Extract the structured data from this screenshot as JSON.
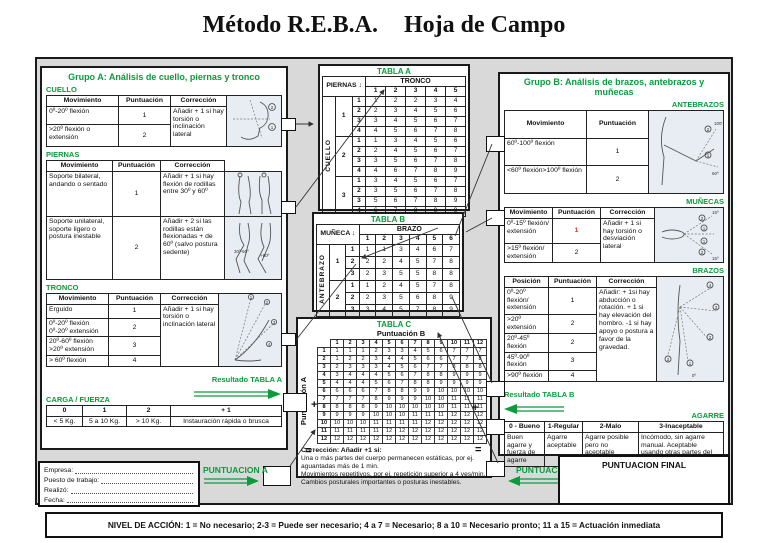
{
  "title": {
    "left": "Método R.E.B.A.",
    "right": "Hoja de Campo"
  },
  "icons": {
    "down_arrow": "↓"
  },
  "operators": {
    "plus": "+",
    "equals": "="
  },
  "group_a": {
    "title": "Grupo A: Análisis de cuello, piernas y tronco",
    "cuello": {
      "label": "CUELLO",
      "headers": [
        "Movimiento",
        "Puntuación",
        "Corrección"
      ],
      "rows": [
        [
          "0º-20º flexión",
          "1"
        ],
        [
          ">20º flexión o extensión",
          "2"
        ]
      ],
      "correction": "Añadir + 1 si hay torsión o inclinación lateral"
    },
    "piernas": {
      "label": "PIERNAS",
      "headers": [
        "Movimiento",
        "Puntuación",
        "Corrección"
      ],
      "rows": [
        {
          "mov": "Soporte bilateral, andando o sentado",
          "punt": "1",
          "corr": "Añadir + 1 si hay flexión de rodillas entre 30º y 60º"
        },
        {
          "mov": "Soporte unilateral, soporte ligero o postura inestable",
          "punt": "2",
          "corr": "Añadir + 2 si las rodillas están flexionadas + de 60º (salvo postura sedente)"
        }
      ]
    },
    "tronco": {
      "label": "TRONCO",
      "headers": [
        "Movimiento",
        "Puntuación",
        "Corrección"
      ],
      "rows": [
        [
          "Erguido",
          "1"
        ],
        [
          "0º-20º flexión 0º-20º extensión",
          "2"
        ],
        [
          "20º-60º flexión >20º extensión",
          "3"
        ],
        [
          "> 60º  flexión",
          "4"
        ]
      ],
      "correction": "Añadir + 1 si hay torsión o inclinación lateral"
    },
    "resultado_label": "Resultado TABLA A",
    "carga": {
      "label": "CARGA / FUERZA",
      "headers": [
        "0",
        "1",
        "2",
        "+ 1"
      ],
      "values": [
        "< 5 Kg.",
        "5 a 10 Kg.",
        "> 10 Kg.",
        "Instauración rápida o brusca"
      ]
    }
  },
  "tabla_a": {
    "title": "TABLA A",
    "corner_label": "PIERNAS",
    "col_group": "TRONCO",
    "side_label": "CUELLO",
    "col_labels": [
      "1",
      "2",
      "3",
      "4",
      "5"
    ],
    "groups": [
      {
        "label": "1",
        "rows": [
          [
            1,
            2,
            2,
            3,
            4
          ],
          [
            2,
            3,
            4,
            5,
            6
          ],
          [
            3,
            4,
            5,
            6,
            7
          ],
          [
            4,
            5,
            6,
            7,
            8
          ]
        ]
      },
      {
        "label": "2",
        "rows": [
          [
            1,
            3,
            4,
            5,
            6
          ],
          [
            2,
            4,
            5,
            6,
            7
          ],
          [
            3,
            5,
            6,
            7,
            8
          ],
          [
            4,
            6,
            7,
            8,
            9
          ]
        ]
      },
      {
        "label": "3",
        "rows": [
          [
            3,
            4,
            5,
            6,
            7
          ],
          [
            3,
            5,
            6,
            7,
            8
          ],
          [
            5,
            6,
            7,
            8,
            9
          ],
          [
            6,
            7,
            8,
            9,
            9
          ]
        ]
      }
    ]
  },
  "tabla_b": {
    "title": "TABLA B",
    "corner_label": "MUÑECA",
    "col_group": "BRAZO",
    "side_label": "ANTEBRAZO",
    "col_labels": [
      "1",
      "2",
      "3",
      "4",
      "5",
      "6"
    ],
    "groups": [
      {
        "label": "1",
        "rows": [
          [
            1,
            1,
            3,
            4,
            6,
            7
          ],
          [
            2,
            2,
            4,
            5,
            7,
            8
          ],
          [
            2,
            3,
            5,
            5,
            8,
            8
          ]
        ]
      },
      {
        "label": "2",
        "rows": [
          [
            1,
            2,
            4,
            5,
            7,
            8
          ],
          [
            2,
            3,
            5,
            6,
            8,
            9
          ],
          [
            3,
            4,
            5,
            7,
            8,
            9
          ]
        ]
      }
    ]
  },
  "tabla_c": {
    "title": "TABLA C",
    "col_label": "Puntuación B",
    "row_label": "Puntuación A",
    "col_labels": [
      "1",
      "2",
      "3",
      "4",
      "5",
      "6",
      "7",
      "8",
      "9",
      "10",
      "11",
      "12"
    ],
    "rows": [
      [
        1,
        1,
        1,
        2,
        3,
        3,
        4,
        5,
        6,
        7,
        7,
        7
      ],
      [
        1,
        2,
        2,
        3,
        4,
        4,
        5,
        6,
        6,
        7,
        7,
        8
      ],
      [
        2,
        3,
        3,
        3,
        4,
        5,
        6,
        7,
        7,
        8,
        8,
        8
      ],
      [
        3,
        4,
        4,
        4,
        5,
        6,
        7,
        8,
        8,
        9,
        9,
        9
      ],
      [
        4,
        4,
        4,
        5,
        6,
        7,
        8,
        8,
        9,
        9,
        9,
        9
      ],
      [
        6,
        6,
        6,
        7,
        8,
        8,
        9,
        9,
        10,
        10,
        10,
        10
      ],
      [
        7,
        7,
        7,
        8,
        9,
        9,
        9,
        10,
        10,
        11,
        11,
        11
      ],
      [
        8,
        8,
        8,
        9,
        10,
        10,
        10,
        10,
        10,
        11,
        11,
        11
      ],
      [
        9,
        9,
        9,
        10,
        10,
        10,
        11,
        11,
        11,
        12,
        12,
        12
      ],
      [
        10,
        10,
        10,
        11,
        11,
        11,
        11,
        12,
        12,
        12,
        12,
        12
      ],
      [
        11,
        11,
        11,
        11,
        12,
        12,
        12,
        12,
        12,
        12,
        12,
        12
      ],
      [
        12,
        12,
        12,
        12,
        12,
        12,
        12,
        12,
        12,
        12,
        12,
        12
      ]
    ],
    "correction_title": "Corrección: Añadir +1 si:",
    "correction_items": [
      "Una o más partes del cuerpo permanecen estáticas, por ej. aguantadas más de 1 min.",
      "Movimientos repetitivos, por ej. repetición superior a 4 ves/min.",
      "Cambios posturales importantes o posturas inestables."
    ]
  },
  "group_b": {
    "title": "Grupo B: Análisis de brazos, antebrazos y muñecas",
    "antebrazos": {
      "label": "ANTEBRAZOS",
      "headers": [
        "Movimiento",
        "Puntuación"
      ],
      "rows": [
        [
          "60º-100º flexión",
          "1"
        ],
        [
          "<60º flexión>100º flexión",
          "2"
        ]
      ]
    },
    "munecas": {
      "label": "MUÑECAS",
      "headers": [
        "Movimiento",
        "Puntuación",
        "Corrección"
      ],
      "rows": [
        [
          "0º-15º flexión/ extensión",
          "1"
        ],
        [
          ">15º flexión/ extensión",
          "2"
        ]
      ],
      "correction": "Añadir + 1 si hay torsión o desviación lateral"
    },
    "brazos": {
      "label": "BRAZOS",
      "headers": [
        "Posición",
        "Puntuación",
        "Corrección"
      ],
      "rows": [
        [
          "0º-20º flexión/ extensión",
          "1"
        ],
        [
          ">20º extensión",
          "2"
        ],
        [
          "20º-45º flexión",
          "2"
        ],
        [
          "45º-90º flexión",
          "3"
        ],
        [
          ">90º flexión",
          "4"
        ]
      ],
      "correction": "Añadir: + 1si hay abducción o rotación. + 1 si hay elevación del hombro. -1 si hay apoyo o postura a favor de la gravedad."
    },
    "resultado_label": "Resultado TABLA B",
    "agarre": {
      "label": "AGARRE",
      "headers": [
        "0 - Bueno",
        "1-Regular",
        "2-Malo",
        "3-Inaceptable"
      ],
      "values": [
        "Buen agarre y fuerza de agarre",
        "Agarre aceptable",
        "Agarre posible pero no aceptable",
        "Incómodo, sin agarre manual. Aceptable usando otras partes del cuerpo"
      ]
    }
  },
  "footer": {
    "fields": [
      {
        "label": "Empresa:"
      },
      {
        "label": "Puesto de trabajo:"
      },
      {
        "label": "Realizó:"
      },
      {
        "label": "Fecha:"
      }
    ],
    "puntuacion_a": "PUNTUACION  A",
    "puntuacion_b": "PUNTUACION  B",
    "puntuacion_final": "PUNTUACION FINAL",
    "nivel": "NIVEL DE ACCIÓN: 1 = No necesario; 2-3 = Puede ser necesario; 4 a 7 = Necesario; 8 a 10 = Necesario pronto; 11 a 15 = Actuación inmediata"
  },
  "colors": {
    "green": "#0a9b3d",
    "red": "#d43325"
  }
}
